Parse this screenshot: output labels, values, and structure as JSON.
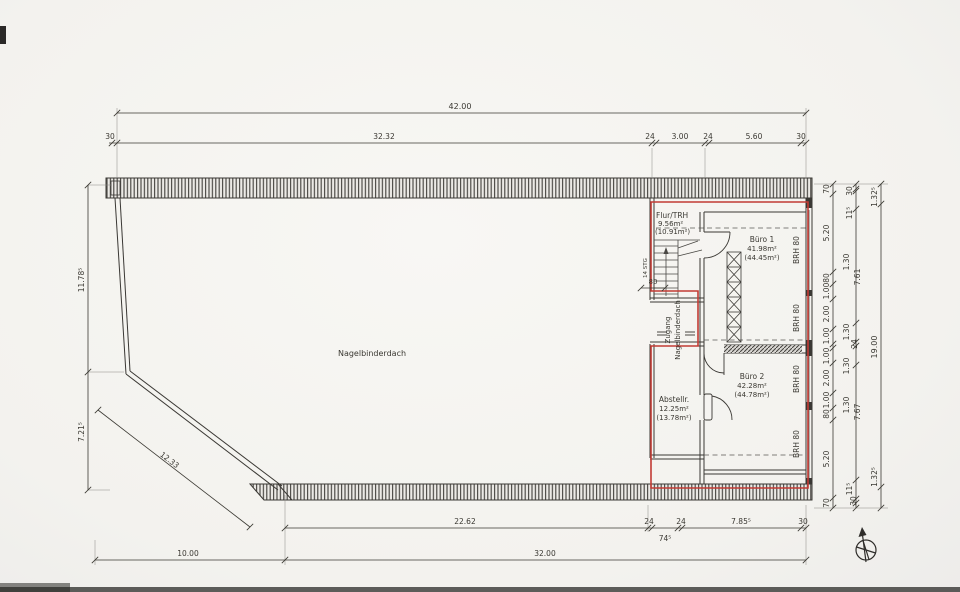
{
  "plan": {
    "hall_label": "Nagelbinderdach",
    "access_label_1": "Zugang",
    "access_label_2": "Nagelbinderdach",
    "stairs_label": "14 STG",
    "brh_label": "BRH 80",
    "opening_width": "80",
    "rooms": {
      "flur": {
        "name": "Flur/TRH",
        "area": "9.56m²",
        "area_gross": "(10.91m²)"
      },
      "buero1": {
        "name": "Büro 1",
        "area": "41.98m²",
        "area_gross": "(44.45m²)"
      },
      "buero2": {
        "name": "Büro 2",
        "area": "42.28m²",
        "area_gross": "(44.78m²)"
      },
      "abstell": {
        "name": "Abstellr.",
        "area": "12.25m²",
        "area_gross": "(13.78m²)"
      }
    }
  },
  "dims": {
    "top_total": "42.00",
    "top": [
      "30",
      "32.32",
      "24",
      "3.00",
      "24",
      "5.60",
      "30"
    ],
    "bottom": [
      "22.62",
      "24",
      "24",
      "74⁵",
      "7.85⁵",
      "30"
    ],
    "bottom_left": "10.00",
    "bottom_total": "32.00",
    "left_upper": "11.78⁵",
    "left_lower": "7.21⁵",
    "diagonal": "12.33",
    "rightA": [
      "70",
      "5.20",
      "80",
      "1.00",
      "2.00",
      "1.00",
      "1.00",
      "2.00",
      "1.00",
      "80",
      "5.20",
      "70"
    ],
    "rightB": [
      "30",
      "11⁵",
      "1.30",
      "7.61",
      "1.30",
      "24",
      "1.30",
      "1.30",
      "7.67",
      "11⁵",
      "30"
    ],
    "rightC": [
      "1.32⁵",
      "19.00",
      "1.32⁵"
    ]
  },
  "colors": {
    "line": "#3a3834",
    "red": "#c23b34",
    "paper": "#f5f4f1"
  }
}
